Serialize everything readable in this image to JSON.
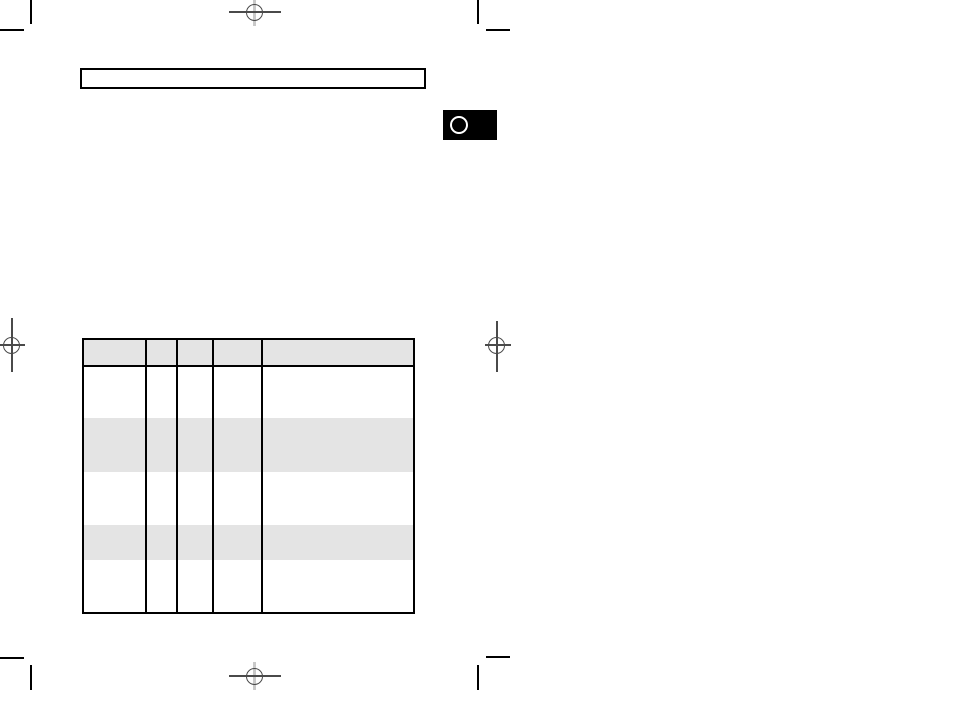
{
  "document": {
    "kind": "print-proof-page",
    "visible_text": "",
    "background_color": "#ffffff"
  },
  "colors": {
    "crop_mark": "#000000",
    "registration_mark_dark": "#4a4a4a",
    "registration_mark_light": "#c9c9c9",
    "table_border": "#000000",
    "table_stripe": "#e4e4e4",
    "badge_background": "#000000",
    "badge_circle_stroke": "#ffffff"
  },
  "title_box": {
    "text": ""
  },
  "page_tab": {
    "label": ""
  },
  "table": {
    "column_widths": [
      61,
      31,
      36,
      49,
      152
    ],
    "header": {
      "shaded": true,
      "labels": [
        "",
        "",
        "",
        "",
        ""
      ]
    },
    "rows": [
      {
        "height": 51,
        "shaded": false,
        "cells": [
          "",
          "",
          "",
          "",
          ""
        ]
      },
      {
        "height": 54,
        "shaded": true,
        "cells": [
          "",
          "",
          "",
          "",
          ""
        ]
      },
      {
        "height": 53,
        "shaded": false,
        "cells": [
          "",
          "",
          "",
          "",
          ""
        ]
      },
      {
        "height": 35,
        "shaded": true,
        "cells": [
          "",
          "",
          "",
          "",
          ""
        ]
      },
      {
        "height": 52,
        "shaded": false,
        "cells": [
          "",
          "",
          "",
          "",
          ""
        ]
      }
    ]
  },
  "print_marks": {
    "corner_crop_marks": [
      "top-left",
      "top-right",
      "bottom-left",
      "bottom-right"
    ],
    "registration_targets": [
      "top-center",
      "left-middle",
      "right-middle",
      "bottom-center"
    ]
  }
}
